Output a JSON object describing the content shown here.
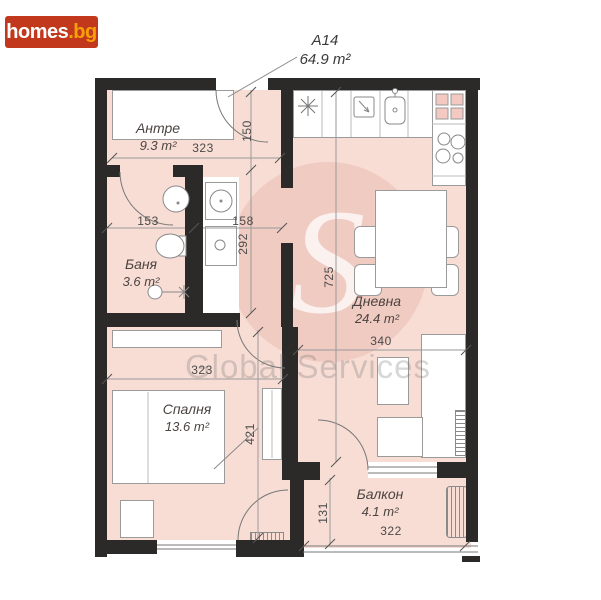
{
  "brand": {
    "name": "homes.bg",
    "logo_primary": "homes",
    "logo_suffix": ".bg"
  },
  "unit": {
    "code": "A14",
    "total_area": "64.9 m²"
  },
  "watermark": {
    "text": "Global Services",
    "monogram": "S"
  },
  "rooms": [
    {
      "name": "Антре",
      "area": "9.3 m²"
    },
    {
      "name": "Баня",
      "area": "3.6 m²"
    },
    {
      "name": "Дневна",
      "area": "24.4 m²"
    },
    {
      "name": "Спалня",
      "area": "13.6 m²"
    },
    {
      "name": "Балкон",
      "area": "4.1 m²"
    }
  ],
  "dimensions_cm": {
    "hall_width": "323",
    "entry_side": "150",
    "bath_width": "153",
    "corridor_width": "158",
    "corridor_depth": "292",
    "living_depth": "725",
    "living_width": "340",
    "bedroom_width": "323",
    "bedroom_depth": "421",
    "balcony_depth": "131",
    "balcony_width": "322"
  },
  "colors": {
    "wall": "#2b2a28",
    "floor": "#f8ddd5",
    "logo_bg": "#c2381c",
    "logo_suffix": "#f5a009"
  }
}
